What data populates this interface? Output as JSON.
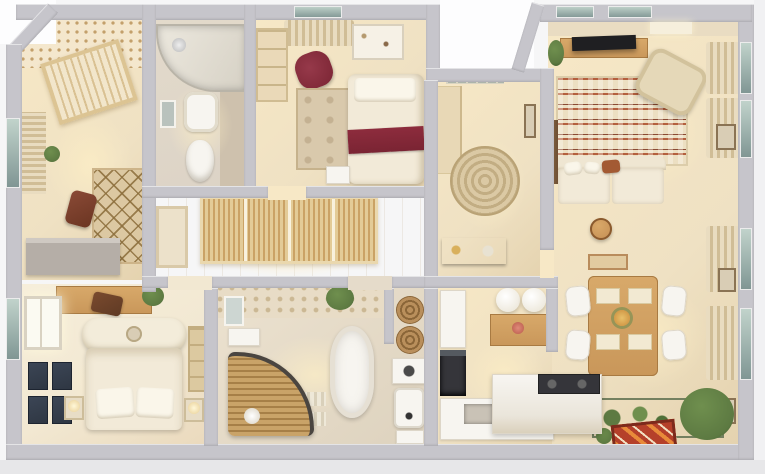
{
  "scene": {
    "type": "3d-floor-plan-render",
    "description": "Photorealistic top-down 3D rendering of a furnished multi-room apartment floor plan with white cut walls and light wood floors",
    "rooms": [
      {
        "name": "nursery",
        "furniture": [
          "polka-dot-accent-wall",
          "crib",
          "window-blinds",
          "plant",
          "diamond-pattern-rug",
          "rocking-toy",
          "gray-desk"
        ]
      },
      {
        "name": "small-bathroom",
        "furniture": [
          "shower-cabin",
          "mirror",
          "sink",
          "toilet",
          "accent-tile-strip"
        ]
      },
      {
        "name": "guest-bedroom",
        "furniture": [
          "top-window-curtains",
          "shelving-unit",
          "wine-red-armchair",
          "white-dresser",
          "bed-with-wine-throw",
          "area-rug",
          "side-table"
        ]
      },
      {
        "name": "entry-hall",
        "furniture": [
          "lattice-transom-window",
          "wardrobe",
          "round-jute-rug",
          "dark-wood-console",
          "wall-art"
        ]
      },
      {
        "name": "living-room",
        "furniture": [
          "tv",
          "media-console",
          "plant",
          "zigzag-rug",
          "patterned-armchair",
          "cream-sofa",
          "rust-pillow",
          "round-stool",
          "wall-mirror",
          "window-curtains",
          "wall-art"
        ]
      },
      {
        "name": "hallway",
        "furniture": [
          "slatted-sliding-wardrobe",
          "mirror-door"
        ]
      },
      {
        "name": "master-bedroom",
        "furniture": [
          "desk",
          "dark-chair",
          "plant",
          "left-window",
          "gallery-frames",
          "upholstered-bed",
          "pillows",
          "nightstands",
          "table-lamps",
          "wardrobe"
        ]
      },
      {
        "name": "main-bathroom",
        "furniture": [
          "hex-tile-wall",
          "vanity-mirror",
          "plant",
          "freestanding-bathtub",
          "bath-mats",
          "curved-walk-in-shower",
          "storage-baskets",
          "shelf-box",
          "water-heater",
          "laundry-door"
        ]
      },
      {
        "name": "kitchen",
        "furniture": [
          "pendant-dome-lamps",
          "wall-cabinet",
          "fridge-column",
          "oven",
          "sink-counter",
          "island-counter",
          "dark-cooktop"
        ]
      },
      {
        "name": "dining-area",
        "furniture": [
          "wall-art",
          "wood-dining-table",
          "placemats",
          "flower-centerpiece",
          "white-chairs",
          "window-curtains",
          "indoor-plant-bed",
          "large-bush",
          "red-accent-mat",
          "ball-plant"
        ]
      }
    ]
  },
  "palette": {
    "outside": "#f6f6f7",
    "outsideWhite": "#fdfdfe",
    "outsideBottom": "#e7e7e9",
    "outsideRight": "#f1f1f3",
    "wall": "#c6c5cb",
    "wallLight": "#dadae0",
    "floor": "#efe1c3",
    "floorWarm": "#f7e8c6",
    "floorLight": "#f2e8d2",
    "tile": "#dcd3c6",
    "tileDark": "#cec1ad",
    "rug": "#dcc8a2",
    "livingRug": "#ecdfc2",
    "livingRugRed": "#b4603e",
    "livingRugDark": "#8a4a33",
    "cream": "#f2ead8",
    "creamDark": "#d9cdb5",
    "white": "#f7f5f0",
    "wood": "#c9975a",
    "woodDark": "#a87a42",
    "woodDeep": "#6e4b2c",
    "wine": "#7a2433",
    "rust": "#a35a33",
    "tv": "#1f1f22",
    "darkAppliance": "#35353a",
    "green": "#5d7a42",
    "greenLight": "#6f8f4e",
    "glassDark": "#7f9593",
    "matRed": "#b5402a",
    "matOrange": "#e88a3a",
    "frameDark": "#2e3642",
    "curtain": "#e9dcc0",
    "curtainShadow": "#d0bd96",
    "wicker": "#b98f5c",
    "wickerDark": "#8a6538",
    "deskGray": "#b5aea7"
  }
}
